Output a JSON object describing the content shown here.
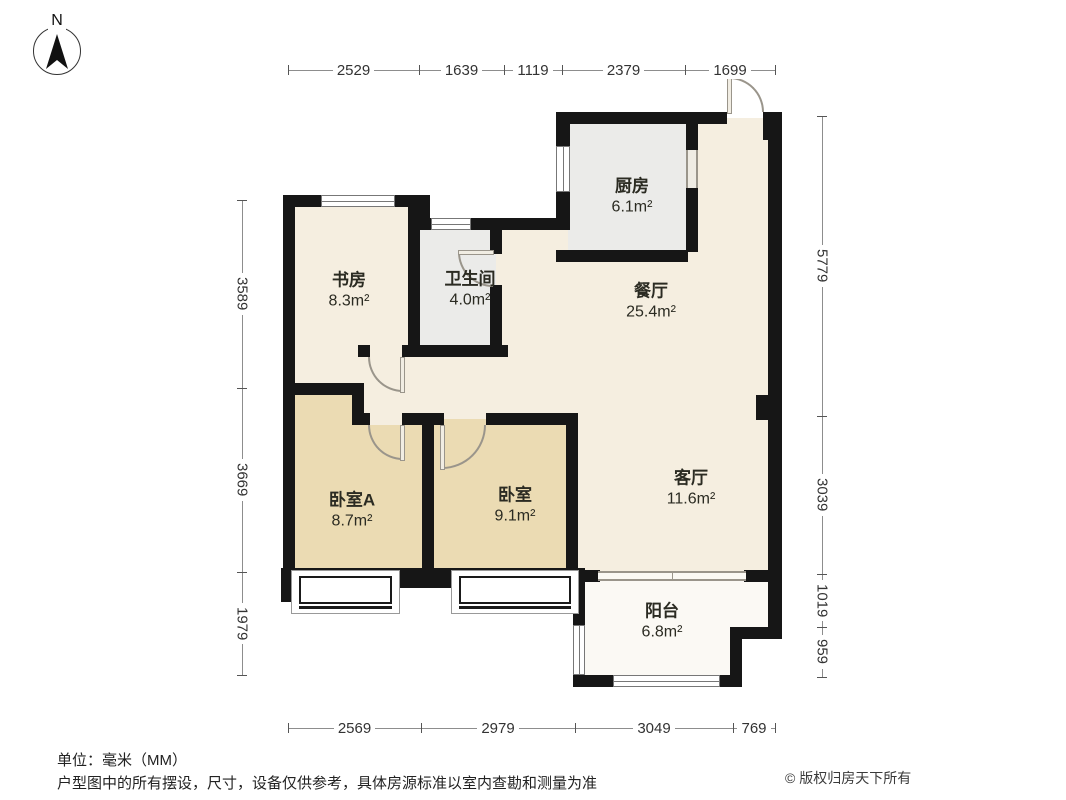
{
  "compass": {
    "north_label": "N"
  },
  "rooms": [
    {
      "name": "书房",
      "area": "8.3m²"
    },
    {
      "name": "卫生间",
      "area": "4.0m²"
    },
    {
      "name": "厨房",
      "area": "6.1m²"
    },
    {
      "name": "餐厅",
      "area": "25.4m²"
    },
    {
      "name": "客厅",
      "area": "11.6m²"
    },
    {
      "name": "卧室A",
      "area": "8.7m²"
    },
    {
      "name": "卧室",
      "area": "9.1m²"
    },
    {
      "name": "阳台",
      "area": "6.8m²"
    }
  ],
  "dimensions": {
    "top": [
      "2529",
      "1639",
      "1119",
      "2379",
      "1699"
    ],
    "bottom": [
      "2569",
      "2979",
      "3049",
      "769"
    ],
    "left": [
      "3589",
      "3669",
      "1979"
    ],
    "right": [
      "5779",
      "3039",
      "1019",
      "959"
    ]
  },
  "footer": {
    "unit_note": "单位：毫米（MM）",
    "disclaimer": "户型图中的所有摆设，尺寸，设备仅供参考，具体房源标准以室内查勘和测量为准",
    "copyright": "© 版权归房天下所有"
  },
  "colors": {
    "wall": "#161616",
    "floor_common": "#f5eee0",
    "floor_bedroom": "#ebdbb3",
    "floor_wet": "#ebebe9",
    "floor_balcony": "#fbf9f4",
    "dimension_line": "#8d8d8d",
    "text": "#2b2b22"
  }
}
